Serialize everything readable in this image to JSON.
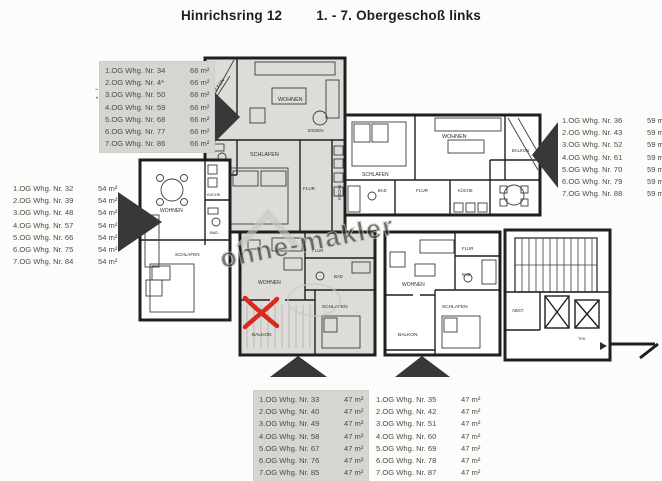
{
  "title": {
    "address": "Hinrichsring 12",
    "floor_range": "1. - 7. Obergeschoß links"
  },
  "lists": {
    "type66": {
      "rows": [
        {
          "label": "1.OG Whg. Nr. 34",
          "area": "66 m²"
        },
        {
          "label": "2.OG Whg. Nr. 4*",
          "area": "66 m²"
        },
        {
          "label": "3.OG Whg. Nr. 50",
          "area": "66 m²"
        },
        {
          "label": "4.OG Whg. Nr. 59",
          "area": "66 m²"
        },
        {
          "label": "5.OG Whg. Nr. 68",
          "area": "66 m²"
        },
        {
          "label": "6.OG Whg. Nr. 77",
          "area": "66 m²"
        },
        {
          "label": "7.OG Whg. Nr. 86",
          "area": "66 m²"
        }
      ]
    },
    "type54": {
      "rows": [
        {
          "label": "1.OG Whg. Nr. 32",
          "area": "54 m²"
        },
        {
          "label": "2.OG Whg. Nr. 39",
          "area": "54 m²"
        },
        {
          "label": "3.OG Whg. Nr. 48",
          "area": "54 m²"
        },
        {
          "label": "4.OG Whg. Nr. 57",
          "area": "54 m²"
        },
        {
          "label": "5.OG Whg. Nr. 66",
          "area": "54 m²"
        },
        {
          "label": "6.OG Whg. Nr. 75",
          "area": "54 m²"
        },
        {
          "label": "7.OG Whg. Nr. 84",
          "area": "54 m²"
        }
      ]
    },
    "type59": {
      "rows": [
        {
          "label": "1.OG Whg. Nr. 36",
          "area": "59 m²"
        },
        {
          "label": "2.OG Whg. Nr. 43",
          "area": "59 m²"
        },
        {
          "label": "3.OG Whg. Nr. 52",
          "area": "59 m²"
        },
        {
          "label": "4.OG Whg. Nr. 61",
          "area": "59 m²"
        },
        {
          "label": "5.OG Whg. Nr. 70",
          "area": "59 m²"
        },
        {
          "label": "6.OG Whg. Nr. 79",
          "area": "59 m²"
        },
        {
          "label": "7.OG Whg. Nr. 88",
          "area": "59 m²"
        }
      ]
    },
    "type47_marked": {
      "rows": [
        {
          "label": "1.OG Whg. Nr. 33",
          "area": "47 m²"
        },
        {
          "label": "2.OG Whg. Nr. 40",
          "area": "47 m²"
        },
        {
          "label": "3.OG Whg. Nr. 49",
          "area": "47 m²"
        },
        {
          "label": "4.OG Whg. Nr. 58",
          "area": "47 m²"
        },
        {
          "label": "5.OG Whg. Nr. 67",
          "area": "47 m²"
        },
        {
          "label": "6.OG Whg. Nr. 76",
          "area": "47 m²"
        },
        {
          "label": "7.OG Whg. Nr. 85",
          "area": "47 m²"
        }
      ]
    },
    "type47": {
      "rows": [
        {
          "label": "1.OG Whg. Nr. 35",
          "area": "47 m²"
        },
        {
          "label": "2.OG Whg. Nr. 42",
          "area": "47 m²"
        },
        {
          "label": "3.OG Whg. Nr. 51",
          "area": "47 m²"
        },
        {
          "label": "4.OG Whg. Nr. 60",
          "area": "47 m²"
        },
        {
          "label": "5.OG Whg. Nr. 69",
          "area": "47 m²"
        },
        {
          "label": "6.OG Whg. Nr. 78",
          "area": "47 m²"
        },
        {
          "label": "7.OG Whg. Nr. 87",
          "area": "47 m²"
        }
      ]
    },
    "stray_marks": [
      {
        "glyph": "-"
      },
      {
        "glyph": "•"
      }
    ]
  },
  "plan": {
    "watermark": "ohne-makler",
    "labels": {
      "balkon": "BALKON",
      "wohnen": "WOHNEN",
      "schlafen": "SCHLAFEN",
      "bad": "BAD",
      "flur": "FLUR",
      "kueche": "KÜCHE",
      "essen": "ESSEN",
      "abst": "ABST.",
      "trh": "TRH."
    }
  },
  "colors": {
    "wall": "#1f1f1f",
    "shade": "#dedcd8",
    "red_mark": "#d92a1f",
    "arrow": "#383838",
    "watermark": "#c9c8c2",
    "box_bg": "#d7d5d1"
  }
}
